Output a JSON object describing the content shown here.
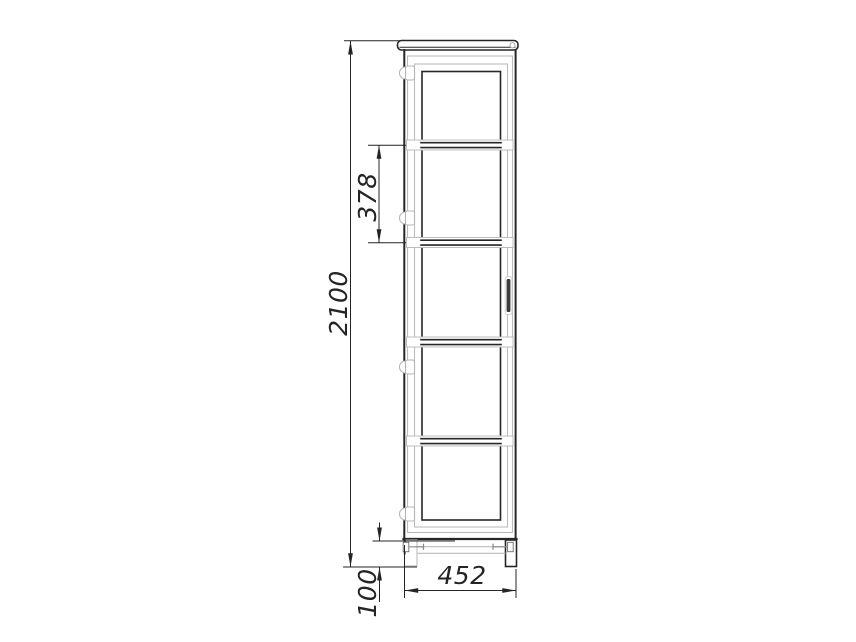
{
  "drawing": {
    "dims": {
      "overall_height": "2100",
      "shelf_spacing": "378",
      "plinth_height": "100",
      "overall_width": "452"
    },
    "colors": {
      "background": "#ffffff",
      "line_dark": "#262626",
      "line_light": "#bcbcbc",
      "handle_fill": "#3a3a3a"
    }
  }
}
